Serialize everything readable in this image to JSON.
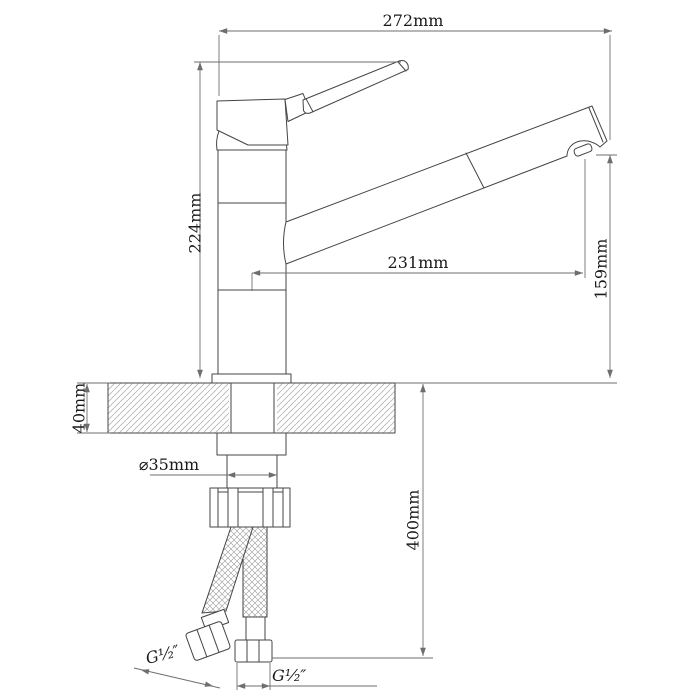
{
  "drawing": {
    "type": "faucet-installation-dimension-drawing",
    "dimensions": {
      "overall_width": "272mm",
      "height_above_counter": "224mm",
      "spout_reach": "231mm",
      "spout_outlet_height": "159mm",
      "counter_thickness": "40mm",
      "hole_diameter": "⌀35mm",
      "hose_length": "400mm",
      "left_hose_thread": "G¹⁄₂″",
      "right_hose_thread": "G¹⁄₂″"
    },
    "colors": {
      "outline": "#454545",
      "dimension_lines": "#6e6e6e",
      "text": "#1a1a1a",
      "hatch": "#b8b8b8",
      "background": "#ffffff"
    }
  }
}
